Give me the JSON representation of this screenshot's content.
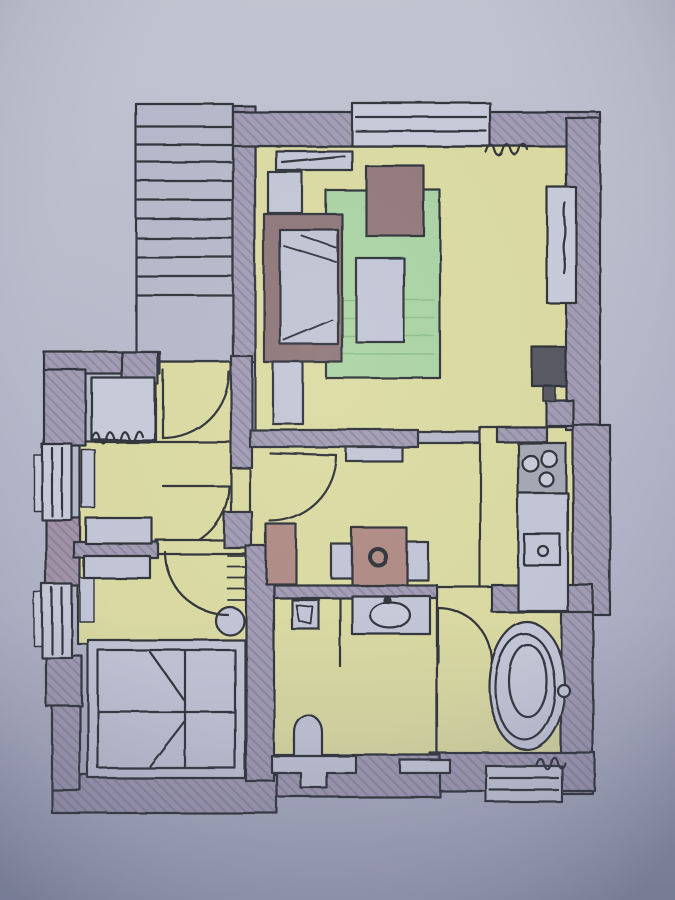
{
  "meta": {
    "kind": "hand-drawn apartment floor plan, ink pen with colored-pencil shading, photographed on blue-grey paper",
    "canvas": {
      "width": 675,
      "height": 900
    }
  },
  "palette": {
    "paper_top": "#c3c5d2",
    "paper_mid": "#b5b8ca",
    "paper_bottom": "#a9adc2",
    "wall": "#a19cb4",
    "wall_mauve": "#a292a6",
    "hatch_line": "rgba(72,62,95,0.22)",
    "ink": "#2f3038",
    "floor": "#dcdb9f",
    "rug": "#a9d3a2",
    "rug_stripe": "rgba(90,150,95,0.35)",
    "sofa": "#8f7477",
    "sofa_cushion": "#c0c3d4",
    "armchair": "#93787a",
    "dining_wood": "#b18a82",
    "furniture_light": "#c3c6d7",
    "window_light": "#c8cbda",
    "stair_fill": "#b6b9cb",
    "tub_fill": "#c6c9d9",
    "stove_top": "#a6a7b4",
    "tv_dark": "#565660"
  },
  "plan": {
    "rooms": [
      {
        "name": "stair-hall",
        "features": [
          "staircase-10-steps",
          "landing",
          "entry-door-arc",
          "closet",
          "radiator-squiggle"
        ]
      },
      {
        "name": "living-room",
        "features": [
          "top-window",
          "curtain-squiggle",
          "sideboard",
          "wall-shelves",
          "sofa-with-cushions",
          "armchair",
          "green-rug",
          "coffee-table",
          "tv",
          "flue",
          "right-wall-niche-window",
          "door-arc-to-dining"
        ]
      },
      {
        "name": "kitchen",
        "features": [
          "stove-3-burners",
          "counter",
          "sink-with-drain"
        ]
      },
      {
        "name": "dining-area",
        "features": [
          "square-table",
          "fruit-bowl",
          "chair-left",
          "chair-right",
          "tall-cabinet",
          "wall-shelf"
        ]
      },
      {
        "name": "vestibule-room",
        "features": [
          "double-window",
          "pilaster",
          "dresser",
          "door-arc"
        ]
      },
      {
        "name": "bedroom",
        "features": [
          "double-window",
          "dresser",
          "radiator-ticks",
          "stool",
          "double-bed-with-fold-marks",
          "door-arc"
        ]
      },
      {
        "name": "wc",
        "features": [
          "vanity-sink",
          "faucet-dot",
          "corner-basin",
          "partition-line",
          "toilet",
          "step-cabinet",
          "vent-window"
        ]
      },
      {
        "name": "bathroom",
        "features": [
          "oval-bathtub",
          "faucet-knob",
          "radiator-squiggle",
          "bottom-window",
          "door-arc"
        ]
      }
    ]
  }
}
